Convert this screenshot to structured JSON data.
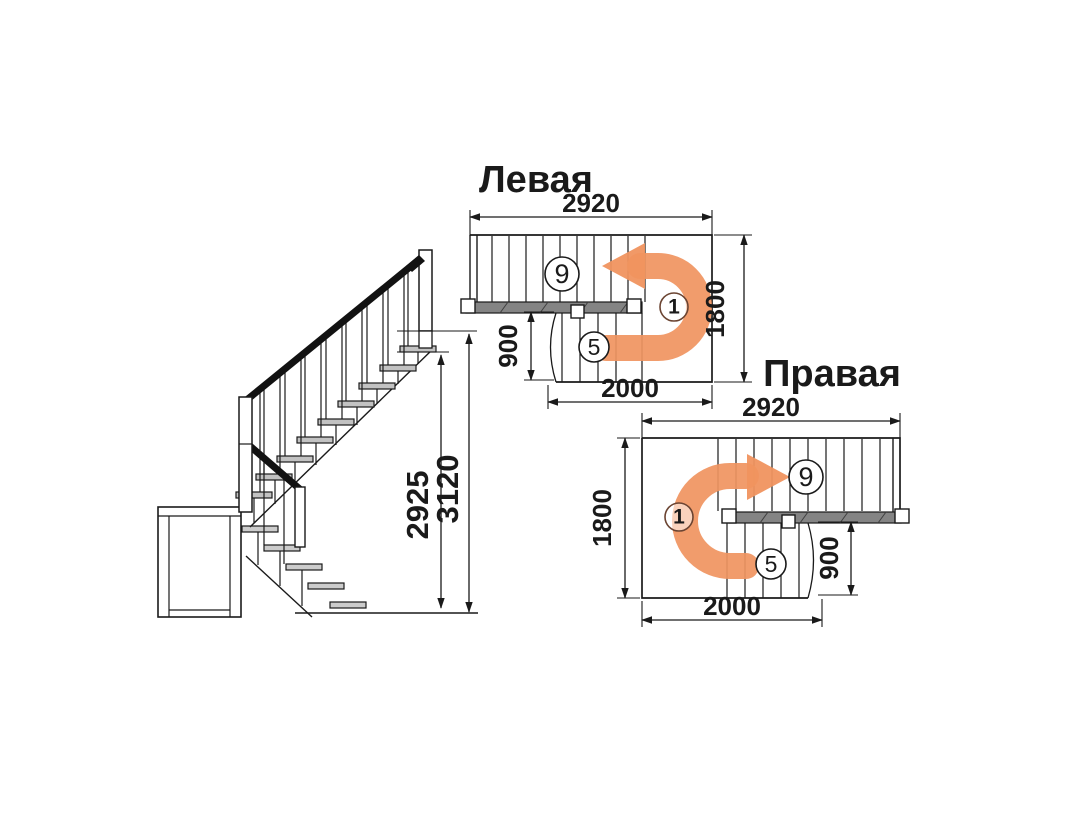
{
  "diagram": {
    "background": "#ffffff",
    "line_color": "#1a1a1a",
    "arrow_color": "#f0945f",
    "turn_text_color": "#b0492a",
    "elevation": {
      "dim_flight_height": "2925",
      "dim_total_height": "3120"
    },
    "left_plan": {
      "title": "Левая",
      "dim_width": "2920",
      "dim_side": "1800",
      "dim_lower_flight_width": "900",
      "dim_lower_flight_length": "2000",
      "upper_steps_label": "9",
      "lower_steps_label": "5",
      "turn_label": "1"
    },
    "right_plan": {
      "title": "Правая",
      "dim_width": "2920",
      "dim_side": "1800",
      "dim_lower_flight_width": "900",
      "dim_lower_flight_length": "2000",
      "upper_steps_label": "9",
      "lower_steps_label": "5",
      "turn_label": "1"
    }
  }
}
